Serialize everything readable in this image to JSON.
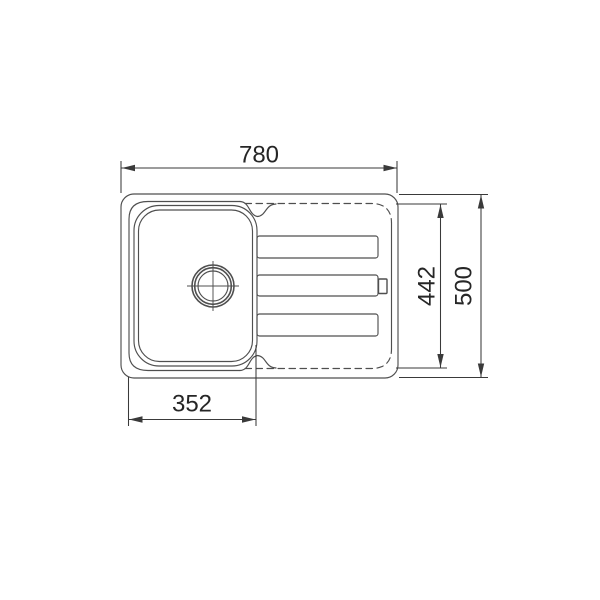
{
  "drawing": {
    "kind": "technical-dimension-drawing",
    "subject": "kitchen sink top view: single bowl with drain symbol and drainboard grooves",
    "dimension_labels": {
      "overall_width": "780",
      "overall_depth": "500",
      "drainer_inner_depth": "442",
      "bowl_outer_width": "352"
    },
    "colors": {
      "background": "#ffffff",
      "line": "#4f4f4f",
      "dimension": "#3a3a3a",
      "text": "#262626"
    }
  }
}
